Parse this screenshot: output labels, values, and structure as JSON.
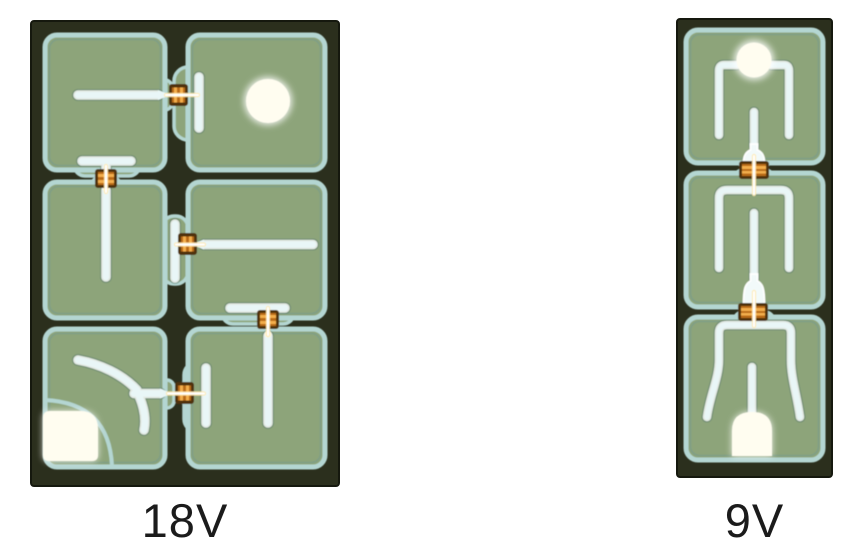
{
  "page": {
    "background": "#ffffff"
  },
  "figure": {
    "left_die": {
      "caption": "18V",
      "cell_count": 6,
      "grid": "2x3"
    },
    "right_die": {
      "caption": "9V",
      "cell_count": 3,
      "grid": "1x3"
    }
  },
  "colors": {
    "page_bg": "#ffffff",
    "die_base": "#2b2f1d",
    "cell_fill": "#8da47a",
    "cell_ring": "#b4d6d2",
    "trace_core": "#e9f6f7",
    "bond_dark": "#4f3210",
    "bond_orange": "#b96a16",
    "bond_orange_bright": "#f3ae4c",
    "pad_white": "#fffdf0",
    "caption_text": "#1b1b1b"
  }
}
